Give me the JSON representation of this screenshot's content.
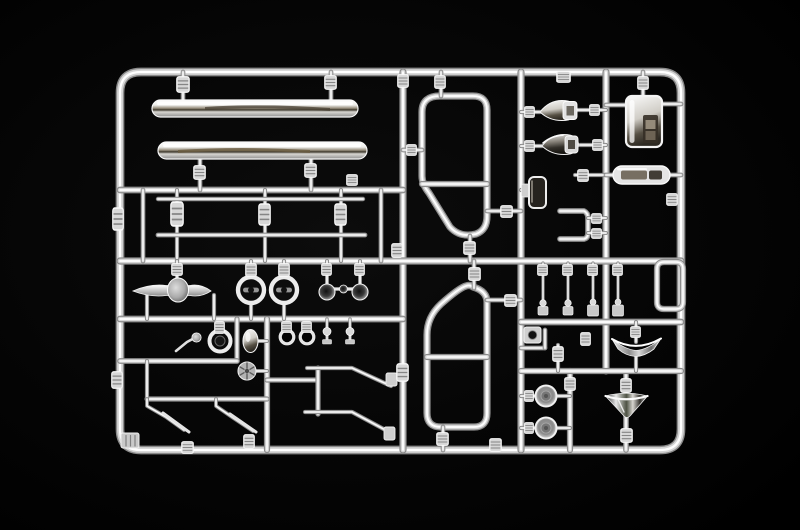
{
  "photo": {
    "subject": "chrome-plated model kit parts sprue (runner tree)",
    "background": "black studio backdrop",
    "finish": "mirror chrome plating on styrene"
  },
  "colors": {
    "background": "#000000",
    "chrome_edge": "#8a8a8a",
    "chrome_base": "#d4d4d4",
    "chrome_core": "#ffffff",
    "dark_reflection": "#4a4234",
    "warm_reflection": "#6b5d41"
  },
  "parts": {
    "frame": "rectangular sprue frame rail",
    "bumper_upper": "chrome front bumper bar (upper)",
    "bumper_lower": "chrome front bumper bar (lower)",
    "trim_rod_upper": "thin chrome trim rod (upper)",
    "trim_rod_lower": "thin chrome trim rod (lower)",
    "hood_ornament": "winged hood ornament emblem",
    "headlight_bezel_left": "headlight bezel ring (left)",
    "headlight_bezel_right": "headlight bezel ring (right)",
    "horn_pair": "paired horn bells with link",
    "small_bezel": "small lamp bezel ring",
    "wiper_crank": "wiper crank lever",
    "oval_lamp": "oval lamp body",
    "ribbed_hub": "ribbed hub disc",
    "grommets": "ring grommets",
    "stem_fittings": "small stem fittings",
    "wiper_arms_left": "wiper arm pair (left)",
    "wiper_arms_right": "wiper arm pair (right)",
    "window_frame_upper": "quarter window frame (upper)",
    "window_frame_lower": "door window frame (lower)",
    "mirror_shell_upper": "mirror housing shell (upper)",
    "mirror_shell_lower": "mirror housing shell (lower)",
    "mirror_glass": "mirror glass insert",
    "mirror_back_plate": "mirror back plate",
    "roof_light_bar": "roof light bar",
    "vent_frame": "rectangular vent frame",
    "antenna_stalks": "antenna stalk parts",
    "deflector_wing": "curved air deflector",
    "horn_trumpet": "horn trumpet funnel",
    "lamp_disc_upper": "lamp reflector disc (upper)",
    "lamp_disc_lower": "lamp reflector disc (lower)",
    "step_brackets": "small mounting brackets",
    "gate_sleeves": "sprue gate sleeves and clips",
    "corner_box": "ribbed corner block"
  }
}
